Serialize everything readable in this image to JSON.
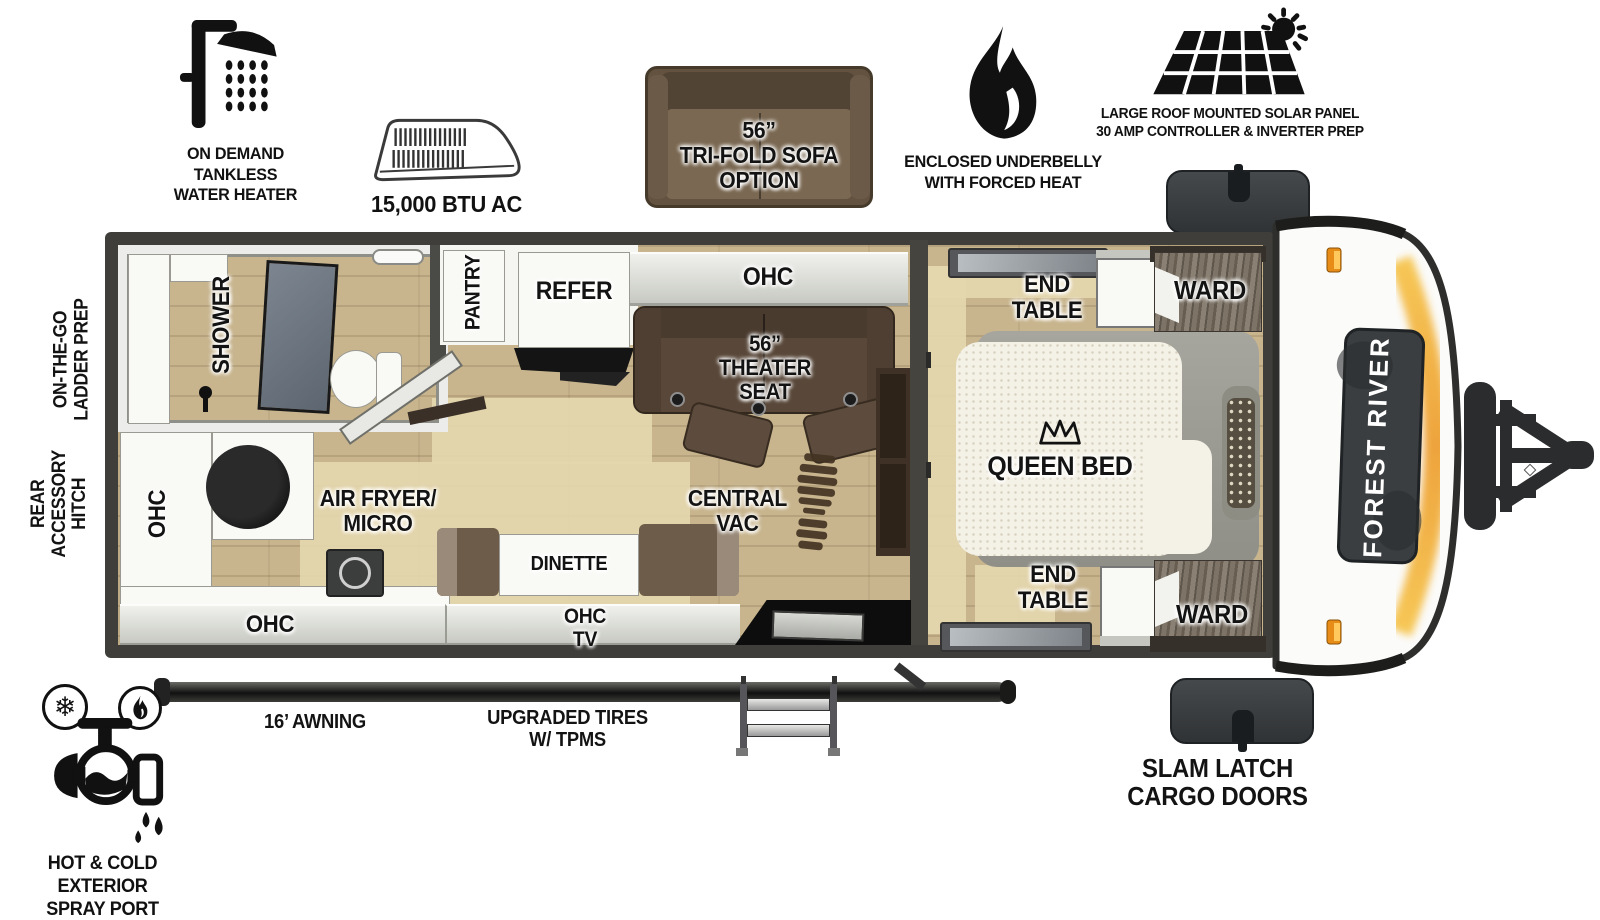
{
  "features": {
    "water_heater": {
      "lines": [
        "ON DEMAND",
        "TANKLESS",
        "WATER HEATER"
      ]
    },
    "ac": {
      "label": "15,000 BTU AC"
    },
    "sofa": {
      "lines": [
        "56”",
        "TRI-FOLD SOFA",
        "OPTION"
      ]
    },
    "underbelly": {
      "lines": [
        "ENCLOSED UNDERBELLY",
        "WITH FORCED HEAT"
      ]
    },
    "solar": {
      "lines": [
        "LARGE ROOF MOUNTED SOLAR PANEL",
        "30 AMP CONTROLLER & INVERTER PREP"
      ]
    }
  },
  "left_callouts": {
    "ladder_prep": {
      "lines": [
        "ON-THE-GO",
        "LADDER PREP"
      ]
    },
    "rear_hitch": {
      "lines": [
        "REAR",
        "ACCESSORY",
        "HITCH"
      ]
    }
  },
  "bottom_callouts": {
    "awning": {
      "label": "16’ AWNING"
    },
    "tires": {
      "lines": [
        "UPGRADED TIRES",
        "W/ TPMS"
      ]
    },
    "cargo_doors": {
      "lines": [
        "SLAM LATCH",
        "CARGO DOORS"
      ]
    },
    "spray_port": {
      "lines": [
        "HOT & COLD EXTERIOR",
        "SPRAY PORT"
      ]
    }
  },
  "floorplan": {
    "bathroom": {
      "shower": "SHOWER"
    },
    "kitchen": {
      "ohc_side": "OHC",
      "appliance": {
        "lines": [
          "AIR FRYER/",
          "MICRO"
        ]
      },
      "ohc_bottom": "OHC",
      "pantry": "PANTRY",
      "refrigerator": "REFER"
    },
    "living": {
      "ohc_top": "OHC",
      "theater_seat": {
        "lines": [
          "56”",
          "THEATER SEAT"
        ]
      },
      "dinette": "DINETTE",
      "ohc_tv": {
        "lines": [
          "OHC",
          "TV"
        ]
      },
      "central_vac": {
        "lines": [
          "CENTRAL",
          "VAC"
        ]
      }
    },
    "bedroom": {
      "bed": "QUEEN BED",
      "end_table_top": {
        "lines": [
          "END",
          "TABLE"
        ]
      },
      "end_table_bottom": {
        "lines": [
          "END",
          "TABLE"
        ]
      },
      "ward_top": "WARD",
      "ward_bottom": "WARD"
    }
  },
  "brand": {
    "front_badge": "FOREST RIVER"
  },
  "colors": {
    "wall": "#3f3e3a",
    "floor": "#c8b58e",
    "rug": "#e4d7ae",
    "counter": "#f9f9f6",
    "cabinet_gray": "#d3d5cf",
    "sofa_brown": "#63523f",
    "theater_brown": "#59483a",
    "ward_wood": "#6f6558",
    "accent_orange": "#efa636"
  }
}
